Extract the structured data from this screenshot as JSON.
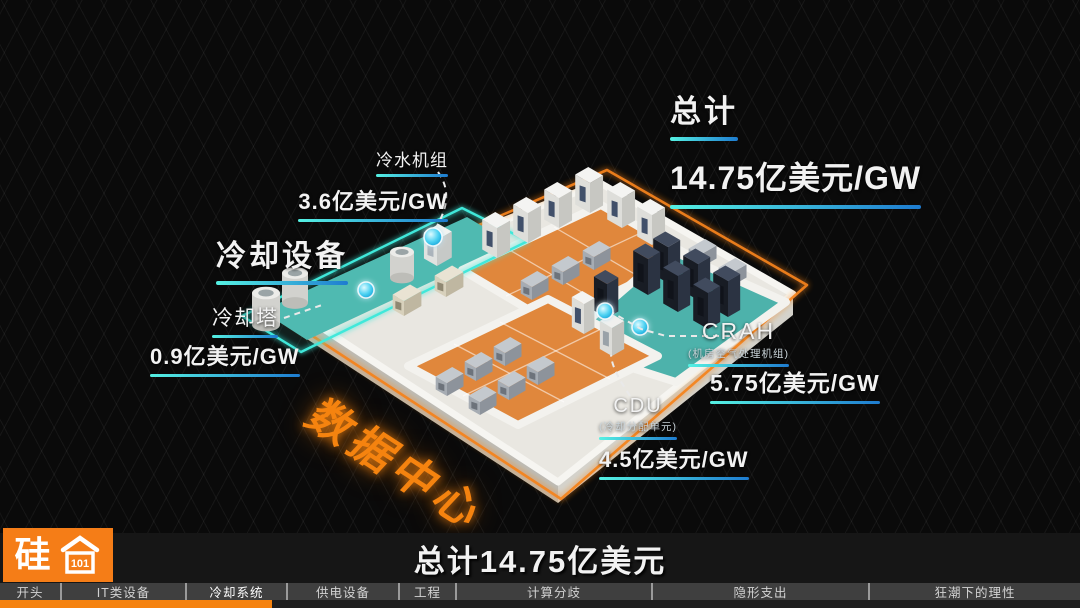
{
  "diagram": {
    "total": {
      "label": "总计",
      "value": "14.75亿美元/GW"
    },
    "floor_label": "数据中心",
    "section_label": "冷却设备",
    "callouts": [
      {
        "id": "chiller",
        "label": "冷水机组",
        "value": "3.6亿美元/GW"
      },
      {
        "id": "cooling-tower",
        "label": "冷却塔",
        "value": "0.9亿美元/GW"
      },
      {
        "id": "crah",
        "label": "CRAH",
        "sublabel": "(机房空气处理机组)",
        "value": "5.75亿美元/GW"
      },
      {
        "id": "cdu",
        "label": "CDU",
        "sublabel": "(冷却分配单元)",
        "value": "4.5亿美元/GW"
      }
    ],
    "equipment_icons": [
      "cooling-tower-icon",
      "chiller-icon",
      "pump-icon",
      "it-cabinet-icon",
      "generator-icon",
      "server-rack-icon",
      "cdu-unit-icon"
    ]
  },
  "footer": {
    "summary_title": "总计14.75亿美元",
    "logo_text": "硅",
    "logo_badge": "101",
    "chapters": [
      "开头",
      "IT类设备",
      "冷却系统",
      "供电设备",
      "工程",
      "计算分歧",
      "隐形支出",
      "狂潮下的理性"
    ],
    "active_chapter": "冷却系统",
    "progress_percent": 25.2
  },
  "colors": {
    "accent_cyan": "#3fe3d6",
    "accent_blue": "#1d7ed2",
    "accent_orange": "#f5831a",
    "floor_orange": "#e0873c",
    "floor_teal": "#4fb5ad"
  }
}
